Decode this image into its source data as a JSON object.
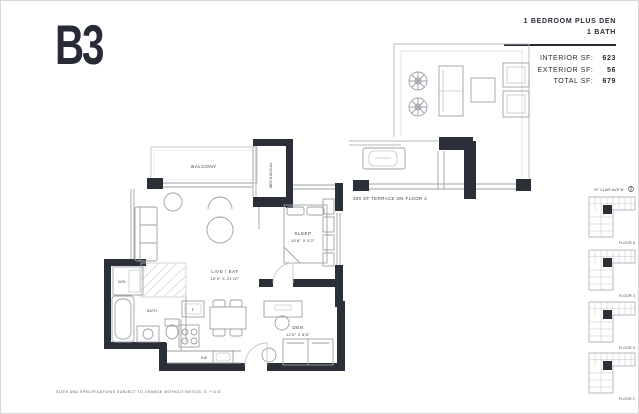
{
  "page": {
    "unit_code": "B3",
    "disclaimer": "SIZES AND SPECIFICATIONS SUBJECT TO CHANGE WITHOUT NOTICE. E. + O.E."
  },
  "summary": {
    "type_line1": "1 BEDROOM PLUS DEN",
    "type_line2": "1 BATH",
    "rows": [
      {
        "label": "INTERIOR SF:",
        "value": "623"
      },
      {
        "label": "EXTERIOR SF:",
        "value": "56"
      },
      {
        "label": "TOTAL SF:",
        "value": "679"
      }
    ]
  },
  "plan": {
    "balcony": "BALCONY",
    "mechanical": "MECHANICAL",
    "sleep": "SLEEP",
    "sleep_dims": "10'6\" X 9'2\"",
    "live_eat": "LIVE / EAT",
    "live_eat_dims": "10'9\" X 21'10\"",
    "den": "DEN",
    "den_dims": "12'0\" X 8'6\"",
    "bath": "BATH",
    "wd": "W/D",
    "fridge": "F",
    "dishwasher": "DW",
    "terrace_note": "300 SF TERRACE ON FLOOR 2"
  },
  "keyplan": {
    "street": "ST CLAIR AVE W",
    "floors": [
      "FLOOR 5",
      "FLOOR 4",
      "FLOOR 3",
      "FLOOR 2"
    ]
  },
  "colors": {
    "wall": "#2b2f38",
    "line": "#9ba0a6",
    "light_line": "#c3c7cb",
    "ink": "#272b35"
  }
}
